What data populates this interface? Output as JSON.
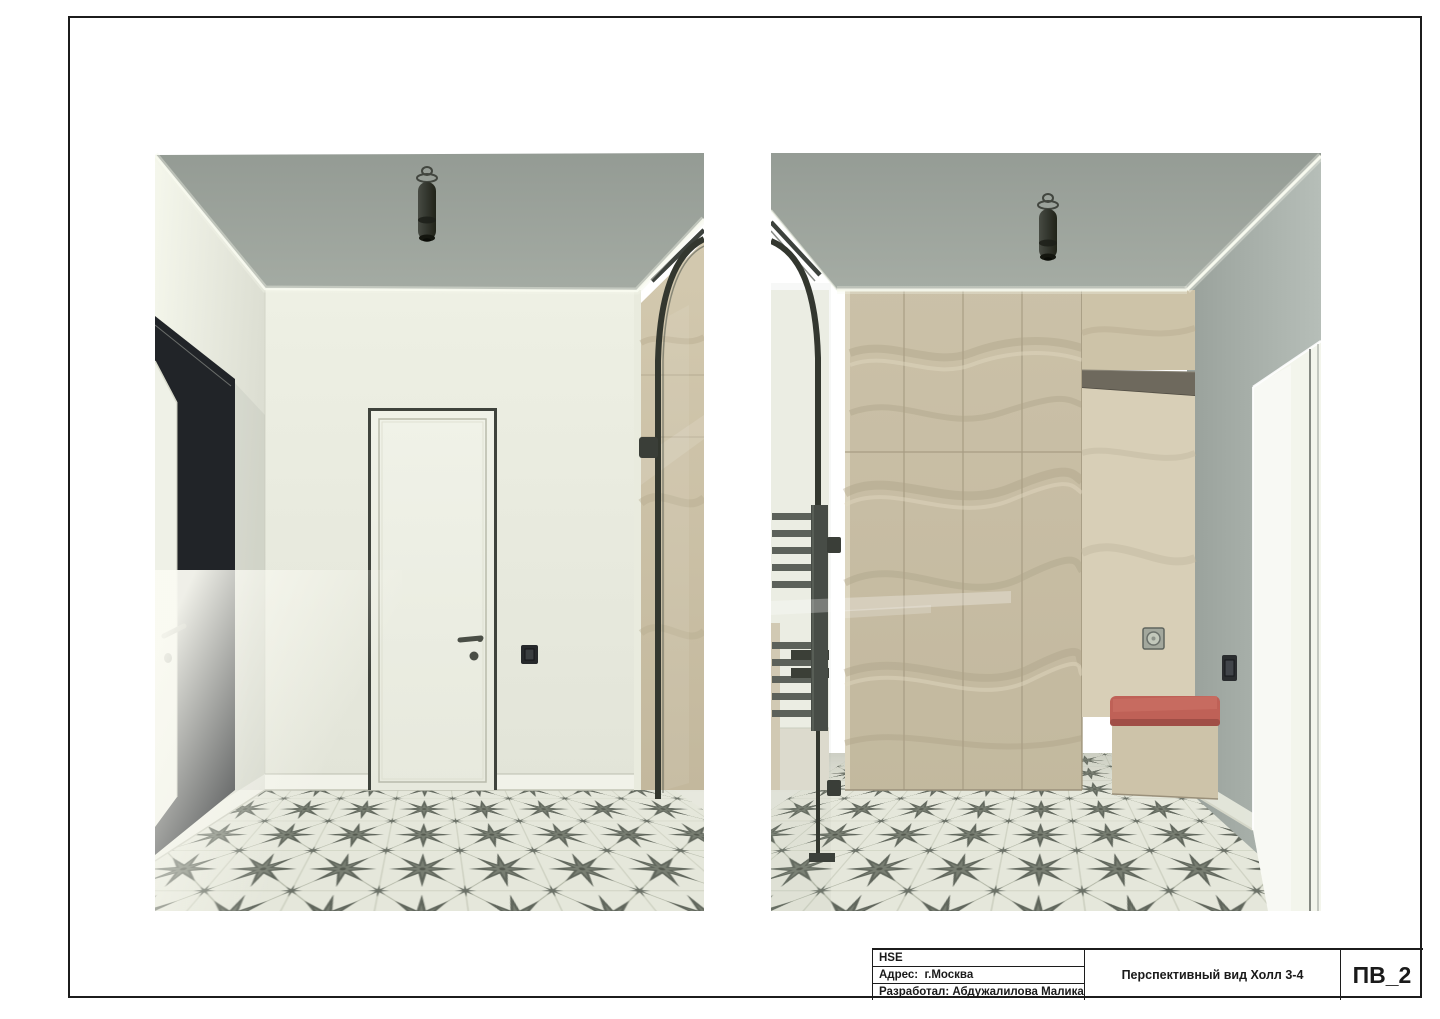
{
  "sheet": {
    "background": "#ffffff",
    "frame_color": "#1c1c1c"
  },
  "title_block": {
    "org": "HSE",
    "address": "Адрес:  г.Москва",
    "developer": "Разработал: Абдужалилова Малика",
    "drawing_title": "Перспективный вид Холл 3-4",
    "sheet_code": "ПВ_2"
  },
  "palette": {
    "ceiling": "#99a099",
    "wall_cream": "#ebede1",
    "wall_gray": "#a7afa9",
    "wardrobe": "#cfc5ab",
    "wardrobe_niche": "#d8cfb7",
    "wardrobe_shadow": "#b4a88c",
    "accent_cushion": "#bf6157",
    "frame_metal": "#474c46",
    "portal_black": "#212428",
    "tile_bg": "#e5e7db",
    "tile_star": "#60665c",
    "cove_glow": "#f6f8ee"
  }
}
